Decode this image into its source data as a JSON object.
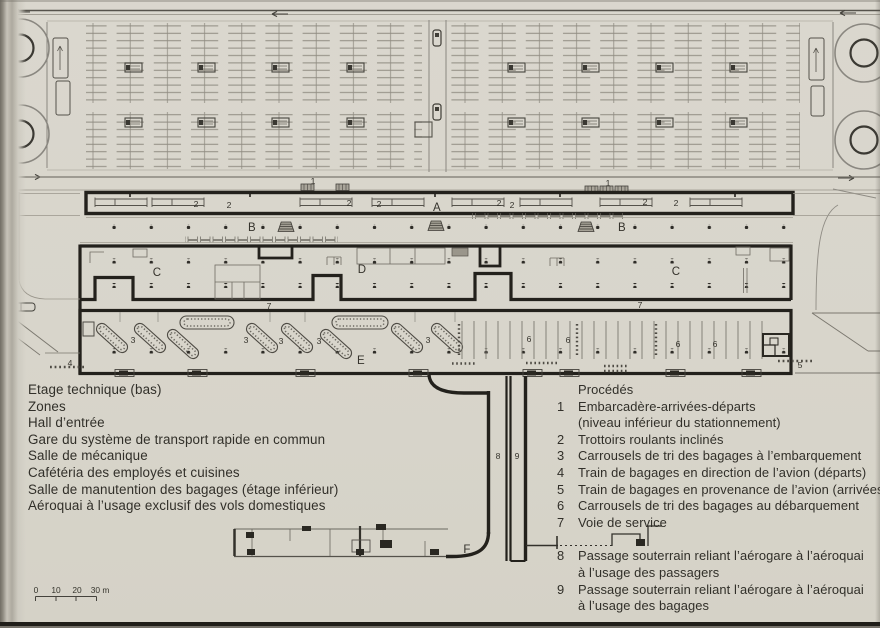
{
  "document": {
    "type": "airport-terminal-floor-plan",
    "paper_color": "#d8d5cb",
    "wall_color": "#23211c",
    "text_color": "#312f29"
  },
  "legend_left": {
    "items": [
      "Etage technique (bas)",
      "Zones",
      "Hall d’entrée",
      "Gare du système de transport rapide en commun",
      "Salle de mécanique",
      "Cafétéria des employés et cuisines",
      "Salle de manutention des bagages (étage inférieur)",
      "Aéroquai à l’usage exclusif des vols domestiques"
    ]
  },
  "legend_right": {
    "rows": [
      {
        "num": "",
        "text": "Procédés"
      },
      {
        "num": "1",
        "text": "Embarcadère-arrivées-départs"
      },
      {
        "num": "",
        "text": "(niveau inférieur du stationnement)"
      },
      {
        "num": "2",
        "text": "Trottoirs roulants inclinés"
      },
      {
        "num": "3",
        "text": "Carrousels de tri des bagages à l’embarquement"
      },
      {
        "num": "4",
        "text": "Train de bagages en direction de l’avion (départs)"
      },
      {
        "num": "5",
        "text": "Train de bagages en provenance de l’avion (arrivées)"
      },
      {
        "num": "6",
        "text": "Carrousels de tri des bagages au débarquement"
      },
      {
        "num": "7",
        "text": "Voie de service"
      },
      {
        "num": "8",
        "text": "Passage souterrain reliant l’aérogare à l’aéroquai"
      },
      {
        "num": "",
        "text": "à l’usage des passagers"
      },
      {
        "num": "9",
        "text": "Passage souterrain reliant l’aérogare à l’aéroquai"
      },
      {
        "num": "",
        "text": "à l’usage des bagages"
      }
    ]
  },
  "plan": {
    "labels": [
      {
        "kind": "zone",
        "text": "A",
        "x": 437,
        "y": 211
      },
      {
        "kind": "zone",
        "text": "B",
        "x": 252,
        "y": 231
      },
      {
        "kind": "zone",
        "text": "B",
        "x": 622,
        "y": 231
      },
      {
        "kind": "zone",
        "text": "C",
        "x": 157,
        "y": 276
      },
      {
        "kind": "zone",
        "text": "D",
        "x": 362,
        "y": 273
      },
      {
        "kind": "zone",
        "text": "C",
        "x": 676,
        "y": 275
      },
      {
        "kind": "zone",
        "text": "E",
        "x": 361,
        "y": 364
      },
      {
        "kind": "zone",
        "text": "F",
        "x": 467,
        "y": 553
      },
      {
        "kind": "num",
        "text": "1",
        "x": 313,
        "y": 184
      },
      {
        "kind": "num",
        "text": "1",
        "x": 608,
        "y": 186
      },
      {
        "kind": "num",
        "text": "2",
        "x": 196,
        "y": 207
      },
      {
        "kind": "num",
        "text": "2",
        "x": 229,
        "y": 208
      },
      {
        "kind": "num",
        "text": "2",
        "x": 349,
        "y": 206
      },
      {
        "kind": "num",
        "text": "2",
        "x": 379,
        "y": 207
      },
      {
        "kind": "num",
        "text": "2",
        "x": 499,
        "y": 206
      },
      {
        "kind": "num",
        "text": "2",
        "x": 512,
        "y": 208
      },
      {
        "kind": "num",
        "text": "2",
        "x": 645,
        "y": 205
      },
      {
        "kind": "num",
        "text": "2",
        "x": 676,
        "y": 206
      },
      {
        "kind": "num",
        "text": "3",
        "x": 133,
        "y": 343
      },
      {
        "kind": "num",
        "text": "3",
        "x": 246,
        "y": 343
      },
      {
        "kind": "num",
        "text": "3",
        "x": 281,
        "y": 344
      },
      {
        "kind": "num",
        "text": "3",
        "x": 319,
        "y": 344
      },
      {
        "kind": "num",
        "text": "3",
        "x": 428,
        "y": 343
      },
      {
        "kind": "num",
        "text": "4",
        "x": 70,
        "y": 366
      },
      {
        "kind": "num",
        "text": "5",
        "x": 800,
        "y": 368
      },
      {
        "kind": "num",
        "text": "6",
        "x": 529,
        "y": 342
      },
      {
        "kind": "num",
        "text": "6",
        "x": 568,
        "y": 343
      },
      {
        "kind": "num",
        "text": "6",
        "x": 678,
        "y": 347
      },
      {
        "kind": "num",
        "text": "6",
        "x": 715,
        "y": 347
      },
      {
        "kind": "num",
        "text": "7",
        "x": 269,
        "y": 309
      },
      {
        "kind": "num",
        "text": "7",
        "x": 640,
        "y": 308
      },
      {
        "kind": "num",
        "text": "8",
        "x": 498,
        "y": 459
      },
      {
        "kind": "num",
        "text": "9",
        "x": 517,
        "y": 459
      },
      {
        "kind": "scale",
        "text": "0",
        "x": 36,
        "y": 593
      },
      {
        "kind": "scale",
        "text": "10",
        "x": 56,
        "y": 593
      },
      {
        "kind": "scale",
        "text": "20",
        "x": 77,
        "y": 593
      },
      {
        "kind": "scale",
        "text": "30 m",
        "x": 100,
        "y": 593
      }
    ]
  }
}
